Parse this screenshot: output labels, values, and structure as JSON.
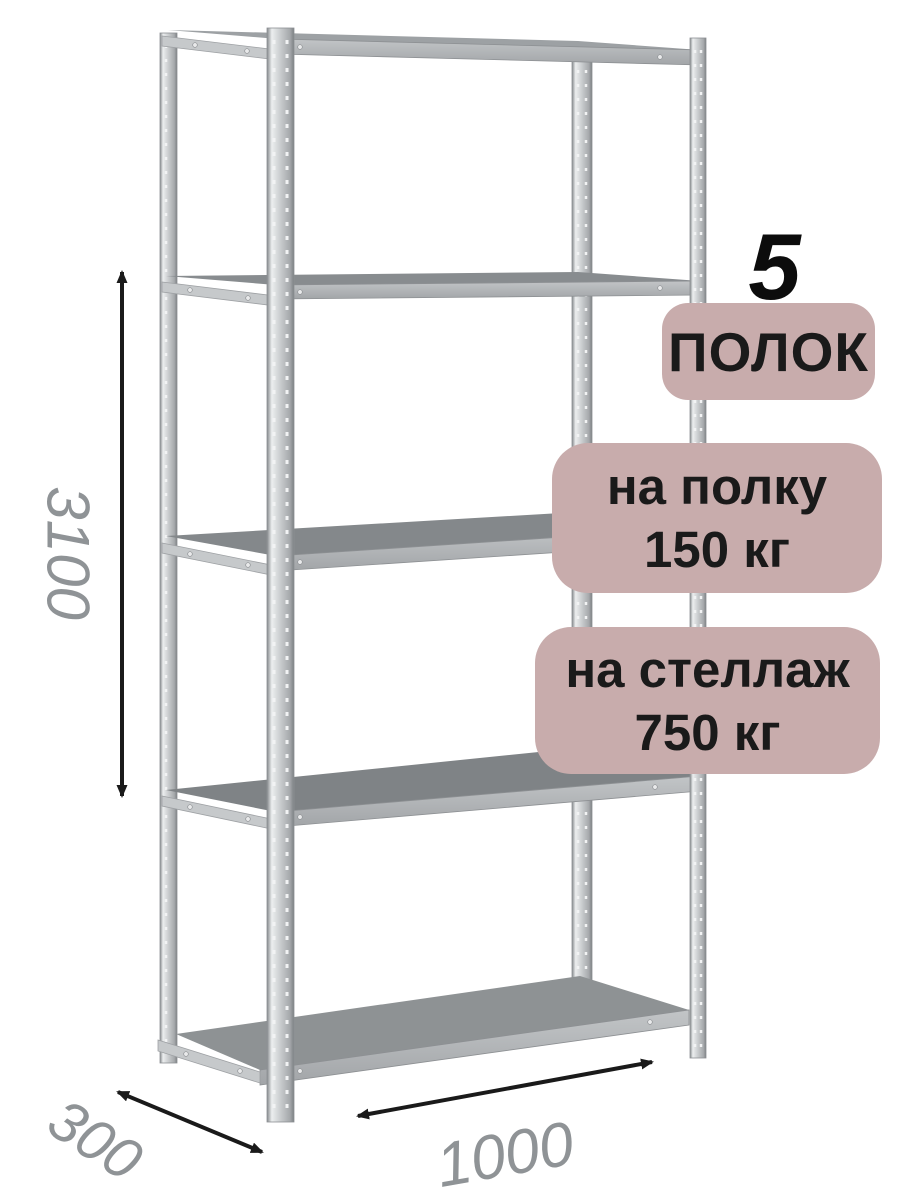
{
  "callouts": {
    "count_number": "5",
    "count_label": "ПОЛОК",
    "per_shelf": {
      "line1": "на полку",
      "line2": "150 кг"
    },
    "per_rack": {
      "line1": "на стеллаж",
      "line2": "750 кг"
    }
  },
  "dimensions": {
    "height": "3100",
    "depth": "300",
    "width": "1000"
  },
  "colors": {
    "badge_background": "#c8acac",
    "badge_text": "#1a1a1a",
    "count_number_text": "#0c0c0c",
    "dimension_text": "#8f9396",
    "arrow": "#1a1a1a",
    "metal_light": "#d9dcde",
    "metal_mid": "#b2b6b9",
    "metal_dark": "#82868a",
    "background": "#ffffff"
  }
}
